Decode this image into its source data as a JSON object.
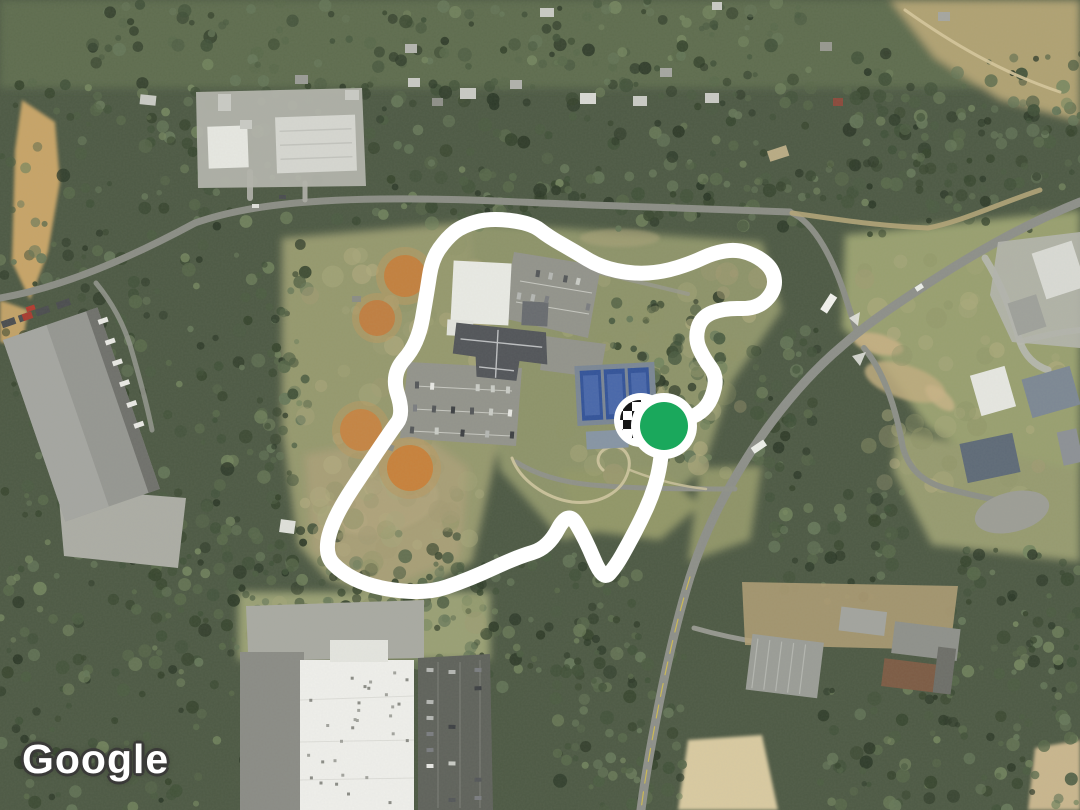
{
  "map": {
    "provider_attribution": "Google",
    "view_type": "satellite",
    "route": {
      "color": "#ffffff",
      "width": 15,
      "closed": true,
      "points": [
        [
          664,
          427
        ],
        [
          684,
          420
        ],
        [
          701,
          413
        ],
        [
          712,
          399
        ],
        [
          717,
          376
        ],
        [
          704,
          359
        ],
        [
          695,
          339
        ],
        [
          701,
          317
        ],
        [
          724,
          308
        ],
        [
          757,
          309
        ],
        [
          775,
          291
        ],
        [
          774,
          271
        ],
        [
          759,
          257
        ],
        [
          737,
          249
        ],
        [
          713,
          253
        ],
        [
          692,
          263
        ],
        [
          663,
          272
        ],
        [
          633,
          274
        ],
        [
          600,
          267
        ],
        [
          574,
          251
        ],
        [
          549,
          237
        ],
        [
          531,
          223
        ],
        [
          490,
          218
        ],
        [
          462,
          226
        ],
        [
          447,
          238
        ],
        [
          432,
          259
        ],
        [
          427,
          292
        ],
        [
          418,
          344
        ],
        [
          391,
          374
        ],
        [
          404,
          414
        ],
        [
          390,
          432
        ],
        [
          315,
          545
        ],
        [
          352,
          583
        ],
        [
          423,
          595
        ],
        [
          470,
          579
        ],
        [
          517,
          557
        ],
        [
          548,
          548
        ],
        [
          568,
          510
        ],
        [
          585,
          538
        ],
        [
          603,
          581
        ],
        [
          616,
          566
        ],
        [
          629,
          543
        ],
        [
          641,
          520
        ],
        [
          651,
          498
        ],
        [
          658,
          476
        ],
        [
          662,
          451
        ],
        [
          664,
          427
        ]
      ]
    },
    "markers": {
      "start": {
        "icon": "checkered-flag-icon",
        "x": 641,
        "y": 420,
        "circle_radius": 27,
        "checker_radius": 20,
        "checker_size": 9,
        "white": "#ffffff",
        "black": "#161616"
      },
      "end": {
        "icon": "current-position-dot",
        "x": 664,
        "y": 426,
        "ring_radius": 33,
        "dot_radius": 24,
        "ring_color": "#ffffff",
        "dot_color": "#1aa85c"
      }
    }
  }
}
